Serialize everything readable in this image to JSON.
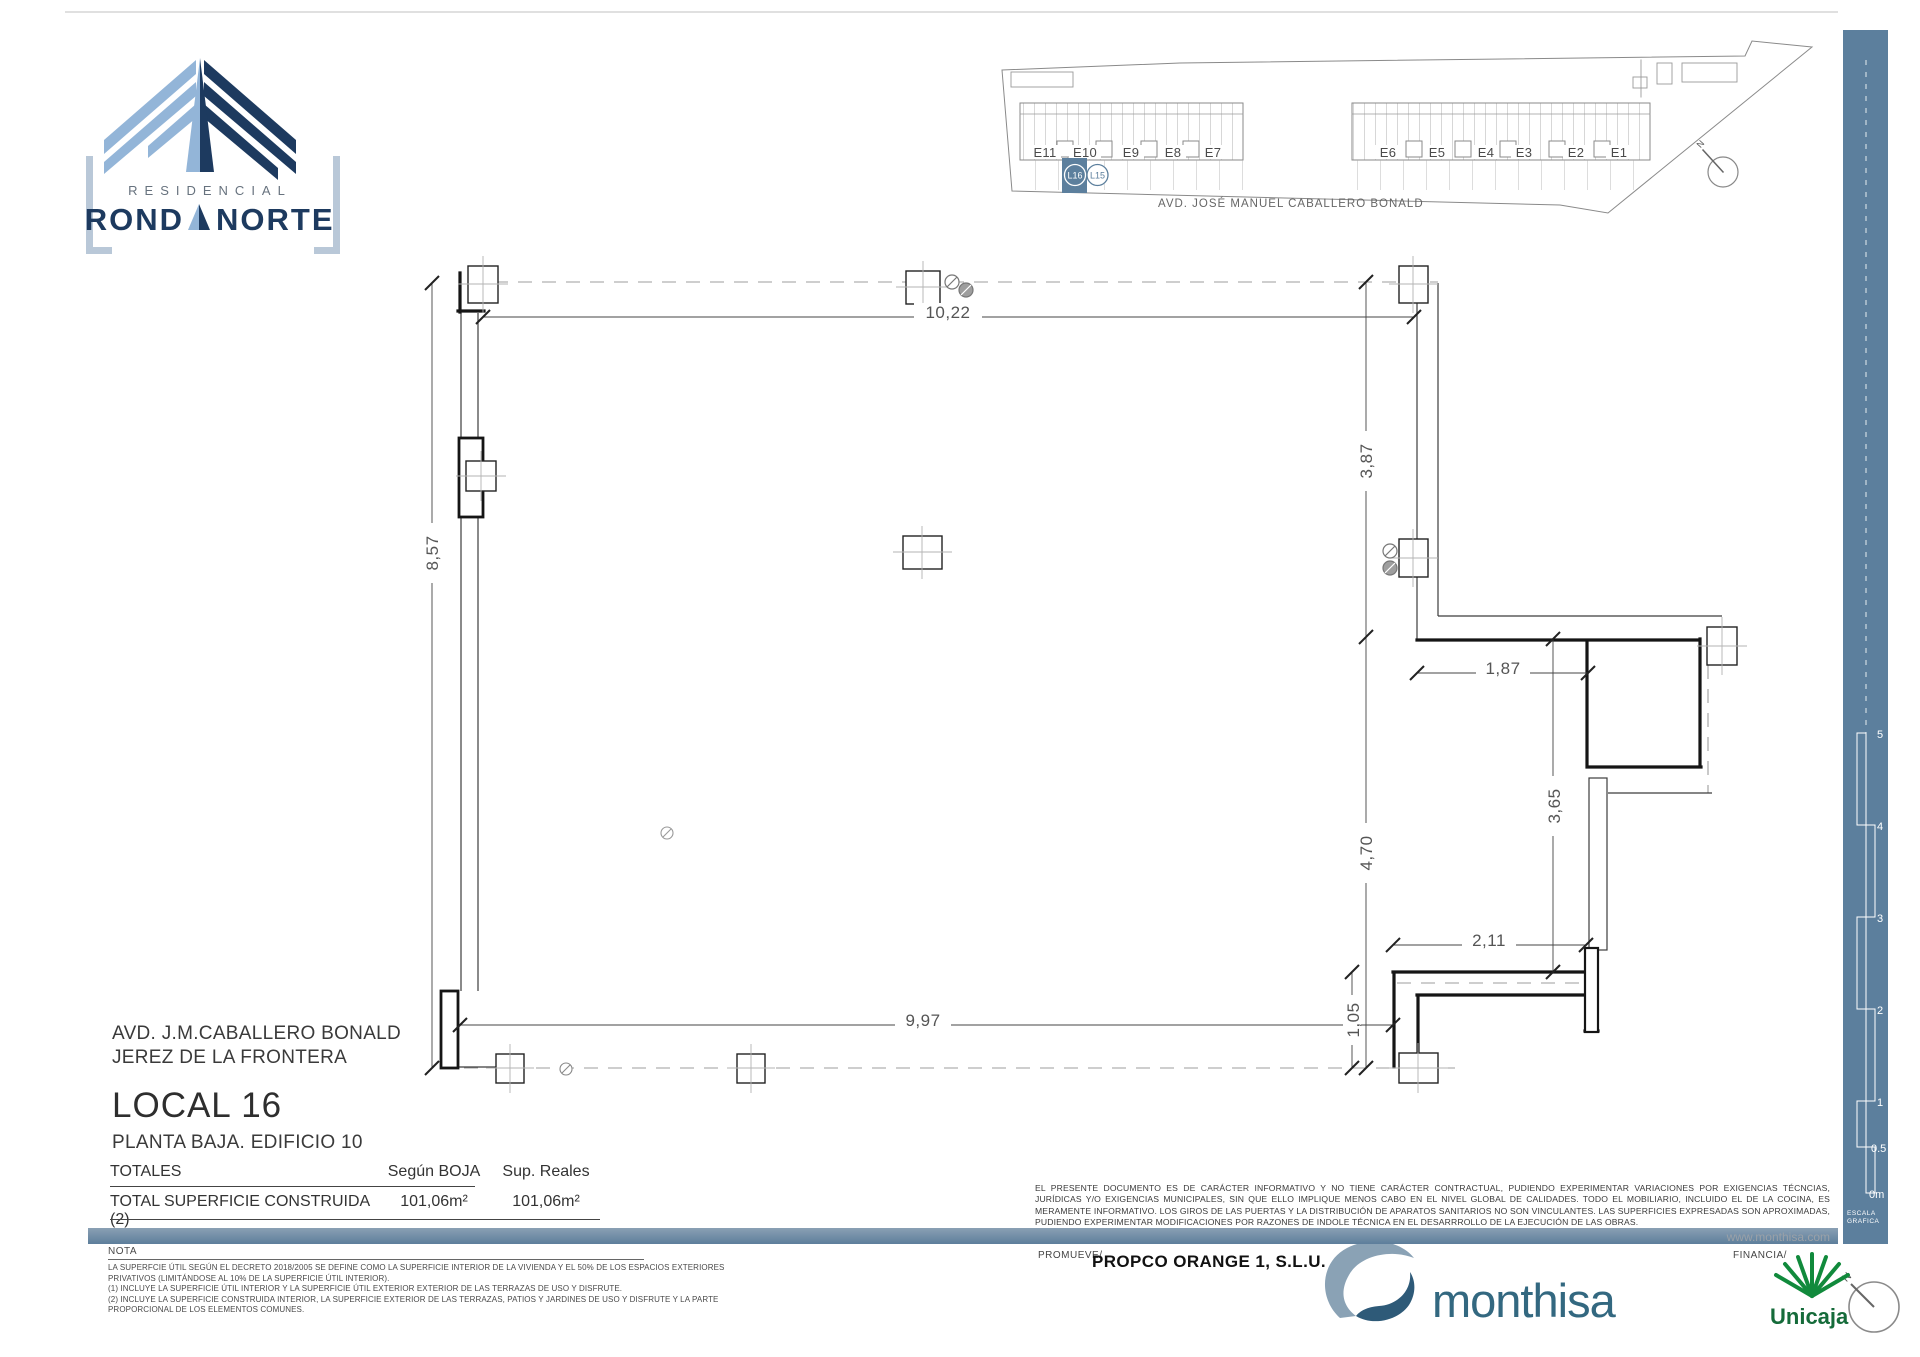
{
  "logo": {
    "residencial": "RESIDENCIAL",
    "name_left": "ROND",
    "name_right": "NORTE"
  },
  "site": {
    "buildings": [
      "E11",
      "E10",
      "E9",
      "E8",
      "E7",
      "E6",
      "E5",
      "E4",
      "E3",
      "E2",
      "E1"
    ],
    "local_highlight": "L16",
    "local_neighbor": "L15",
    "avenue": "AVD. JOSÉ MANUEL  CABALLERO BONALD",
    "north": "N"
  },
  "plan": {
    "dims": {
      "top": "10,22",
      "left": "8,57",
      "right_upper": "3,87",
      "right_lower": "4,70",
      "bottom": "9,97",
      "bottom_inset": "1,05",
      "terrace_width": "1,87",
      "terrace_height": "3,65",
      "step_width": "2,11"
    }
  },
  "info": {
    "address_line1": "AVD. J.M.CABALLERO BONALD",
    "address_line2": "JEREZ DE LA FRONTERA",
    "title": "LOCAL 16",
    "subtitle": "PLANTA BAJA. EDIFICIO 10"
  },
  "totals": {
    "header": "TOTALES",
    "col_boja": "Según BOJA",
    "col_reales": "Sup. Reales",
    "row_label": "TOTAL SUPERFICIE CONSTRUIDA  (2)",
    "boja_value": "101,06m²",
    "reales_value": "101,06m²"
  },
  "nota": {
    "label": "NOTA",
    "lines": [
      "LA SUPERFCIE ÚTIL SEGÚN EL DECRETO 2018/2005 SE DEFINE COMO LA SUPERFICIE INTERIOR DE LA VIVIENDA Y EL 50% DE LOS ESPACIOS EXTERIORES",
      "PRIVATIVOS (LIMITÁNDOSE AL 10% DE LA SUPERFICIE ÚTIL INTERIOR).",
      "(1) INCLUYE LA SUPERFICIE ÚTIL INTERIOR Y LA SUPERFICIE ÚTIL EXTERIOR EXTERIOR DE LAS TERRAZAS DE USO Y DISFRUTE.",
      "(2) INCLUYE LA SUPERFICIE CONSTRUIDA INTERIOR, LA SUPERFICIE EXTERIOR DE LAS TERRAZAS, PATIOS Y JARDINES DE USO Y DISFRUTE  Y LA PARTE",
      "PROPORCIONAL DE LOS ELEMENTOS COMUNES."
    ]
  },
  "legal": {
    "text": "EL PRESENTE DOCUMENTO ES DE CARÁCTER INFORMATIVO Y NO TIENE CARÁCTER CONTRACTUAL, PUDIENDO EXPERIMENTAR VARIACIONES POR EXIGENCIAS TÉCNCIAS, JURÍDICAS Y/O EXIGENCIAS MUNICIPALES, SIN QUE ELLO IMPLIQUE  MENOS CABO EN EL NIVEL GLOBAL DE CALIDADES. TODO EL MOBILIARIO, INCLUIDO EL DE LA COCINA,  ES MERAMENTE INFORMATIVO.  LOS GIROS DE LAS PUERTAS Y LA DISTRIBUCIÓN DE APARATOS SANITARIOS NO SON VINCULANTES. LAS SUPERFICIES EXPRESADAS SON APROXIMADAS, PUDIENDO EXPERIMENTAR MODIFICACIONES POR RAZONES DE INDOLE TÉCNICA EN EL DESARRROLLO DE LA EJECUCIÓN DE LAS OBRAS.",
    "website": "www.monthisa.com"
  },
  "footer": {
    "promueve_label": "PROMUEVE/",
    "promueve_name": "PROPCO ORANGE  1, S.L.U.",
    "monthisa": "monthisa",
    "financia_label": "FINANCIA/",
    "unicaja": "Unicaja"
  },
  "scale": {
    "marks": [
      "5",
      "4",
      "3",
      "2",
      "1",
      "0.5",
      "0m"
    ],
    "caption_line1": "ESCALA",
    "caption_line2": "GRAFICA",
    "north": "N"
  },
  "colors": {
    "accent": "#5C7F9D",
    "navy": "#1D3A5F",
    "light_blue": "#93B5D8",
    "monthisa_blue": "#336880",
    "unicaja_green": "#118A3C"
  }
}
